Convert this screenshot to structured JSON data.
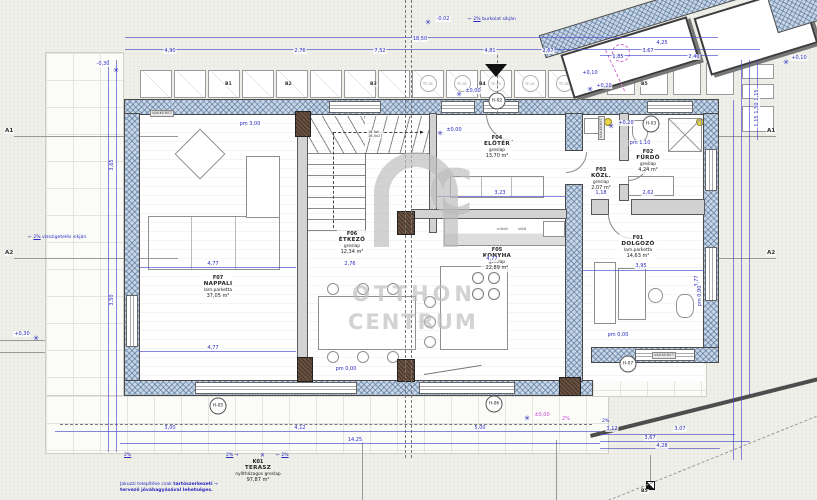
{
  "watermark": {
    "logo_c": "C",
    "line1": "OTTHON",
    "line2": "CENTRUM"
  },
  "labels": {
    "tf": "TF-01",
    "vakkeret": "VAKKERET",
    "mikro": "mikró",
    "suto": "sütő",
    "stair1": "18 fok",
    "stair2": "16,5x27"
  },
  "rooms": [
    {
      "code": "F07",
      "name": "NAPPALI",
      "finish": "lam.parketta",
      "area": "37,05 m²"
    },
    {
      "code": "F06",
      "name": "ÉTKEZŐ",
      "finish": "greslap",
      "area": "12,34 m²"
    },
    {
      "code": "F04",
      "name": "ELŐTÉR",
      "finish": "greslap",
      "area": "13,70 m²"
    },
    {
      "code": "F05",
      "name": "KONYHA",
      "finish": "greslap",
      "area": "22,89 m²"
    },
    {
      "code": "F03",
      "name": "KÖZL.",
      "finish": "greslap",
      "area": "2,07 m²"
    },
    {
      "code": "F02",
      "name": "FÜRDŐ",
      "finish": "greslap",
      "area": "4,24 m²"
    },
    {
      "code": "F01",
      "name": "DOLGOZÓ",
      "finish": "lam.parketta",
      "area": "14,63 m²"
    },
    {
      "code": "K01",
      "name": "TERASZ",
      "finish": "nyílthézagos greslap",
      "area": "97,87 m²"
    }
  ],
  "grid_marks": {
    "a1": "A1",
    "a2": "A2",
    "b1": "B1",
    "b2": "B2",
    "b3": "B3",
    "b4": "B4",
    "b5": "B5"
  },
  "tags": {
    "h02": "H-02",
    "h03": "H-03",
    "h05": "H-05",
    "h06": "H-06",
    "h07": "H-07"
  },
  "levels": {
    "m030": "-0,30",
    "m002": "-0,02",
    "zero": "±0,00",
    "p020": "+0,20",
    "p010": "+0,10",
    "p030": "+0,30"
  },
  "pm": {
    "a": "pm 3,00",
    "b": "pm 1,10",
    "c": "pm 0,00",
    "d": "pm 0,00",
    "e": "pm 0,90"
  },
  "notes": {
    "slope": "2%",
    "slope_top_sub": "burkolat síkján",
    "slope_left_sub": "vízszigetelés síkján",
    "jac1a": "Jakuzzi telepítése csak ",
    "jac1b": "tartószerkezeti",
    "jac2": "tervező jóváhagyásával lehetséges.",
    "arrow_r": "→",
    "arrow_l": "←",
    "x_mark": "✕"
  },
  "dims": {
    "v1850": "18,50",
    "v490": "4,90",
    "v276": "2,76",
    "v752": "7,52",
    "v481": "4,81",
    "v267": "2,67",
    "v425": "4,25",
    "v367": "3,67",
    "v185": "1,85",
    "v240": "2,40",
    "v365": "3,65",
    "v350": "3,50",
    "v477": "4,77",
    "v323": "3,23",
    "v395": "3,95",
    "v377": "3,77",
    "v300": "3,00",
    "v412": "4,12",
    "v500": "5,00",
    "v1425": "14,25",
    "v312": "3,12",
    "v307": "3,07",
    "v428": "4,28",
    "v262": "2,62",
    "v118": "1,18",
    "v115": "1,15",
    "v150": "1,50"
  }
}
